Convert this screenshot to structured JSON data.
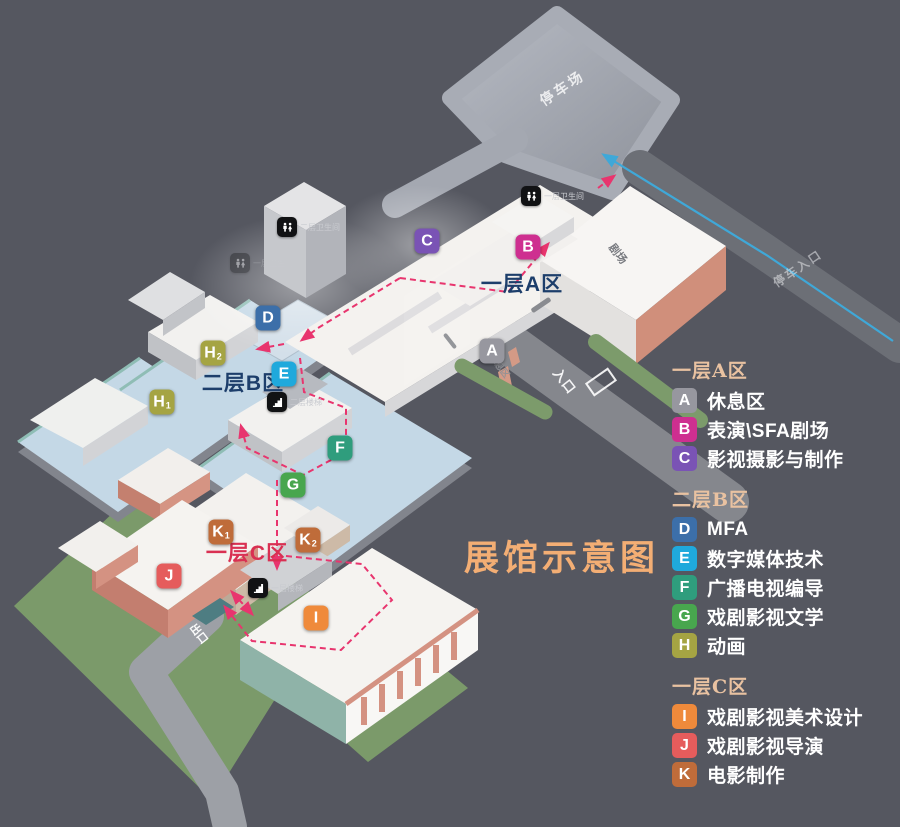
{
  "title": {
    "text": "展馆示意图"
  },
  "colors": {
    "background": "#555760",
    "title": "#f3ae74",
    "legend_header": "#e9c2a1",
    "route_pink": "#e8356e",
    "route_blue": "#3fa8d8",
    "grass": "#7b9a6a",
    "floor_blue": "#c4d8e6"
  },
  "map": {
    "zone_labels": [
      {
        "text": "一层A区",
        "x": 522,
        "y": 283,
        "color": "#1d3e6b"
      },
      {
        "text": "二层B区",
        "x": 243,
        "y": 382,
        "color": "#1d3e6b"
      },
      {
        "text": "一层C区",
        "x": 247,
        "y": 552,
        "color": "#d93052"
      }
    ],
    "markers": [
      {
        "letter": "A",
        "sub": "",
        "x": 492,
        "y": 351,
        "color": "#97979f"
      },
      {
        "letter": "B",
        "sub": "",
        "x": 528,
        "y": 247,
        "color": "#ce2f90"
      },
      {
        "letter": "C",
        "sub": "",
        "x": 427,
        "y": 241,
        "color": "#7a53b5"
      },
      {
        "letter": "D",
        "sub": "",
        "x": 268,
        "y": 318,
        "color": "#3c6fa9"
      },
      {
        "letter": "E",
        "sub": "",
        "x": 284,
        "y": 374,
        "color": "#1fa9dc"
      },
      {
        "letter": "F",
        "sub": "",
        "x": 340,
        "y": 448,
        "color": "#2f9d7d"
      },
      {
        "letter": "G",
        "sub": "",
        "x": 293,
        "y": 485,
        "color": "#48a64e"
      },
      {
        "letter": "H",
        "sub": "1",
        "x": 162,
        "y": 402,
        "color": "#a5a443"
      },
      {
        "letter": "H",
        "sub": "2",
        "x": 213,
        "y": 353,
        "color": "#a5a443"
      },
      {
        "letter": "I",
        "sub": "",
        "x": 316,
        "y": 618,
        "color": "#ef8a3b"
      },
      {
        "letter": "J",
        "sub": "",
        "x": 169,
        "y": 576,
        "color": "#e55c5c"
      },
      {
        "letter": "K",
        "sub": "1",
        "x": 221,
        "y": 532,
        "color": "#bf6c3a"
      },
      {
        "letter": "K",
        "sub": "2",
        "x": 308,
        "y": 540,
        "color": "#bf6c3a"
      }
    ],
    "facilities": [
      {
        "type": "restroom",
        "label": "一层卫生间",
        "x": 531,
        "y": 196,
        "faded": false
      },
      {
        "type": "restroom",
        "label": "二层卫生间",
        "x": 287,
        "y": 227,
        "faded": false
      },
      {
        "type": "restroom",
        "label": "一层卫生间",
        "x": 240,
        "y": 263,
        "faded": true
      },
      {
        "type": "stairs",
        "label": "二层楼梯",
        "x": 277,
        "y": 402,
        "faded": false
      },
      {
        "type": "stairs",
        "label": "一层楼梯",
        "x": 258,
        "y": 588,
        "faded": false
      }
    ],
    "road_labels": [
      {
        "text": "停车场",
        "x": 565,
        "y": 92,
        "rotate": -34,
        "size": 14,
        "color": "#ffffff",
        "opacity": 0.8,
        "spacing": 3
      },
      {
        "text": "停车入口",
        "x": 800,
        "y": 272,
        "rotate": -34,
        "size": 12,
        "color": "#e8e9ec",
        "opacity": 0.55,
        "spacing": 2
      },
      {
        "text": "入口",
        "x": 561,
        "y": 384,
        "rotate": 52,
        "size": 13,
        "color": "#ffffff",
        "opacity": 0.92,
        "spacing": 1
      },
      {
        "text": "出口",
        "x": 196,
        "y": 636,
        "rotate": 52,
        "size": 11,
        "color": "#ffffff",
        "opacity": 0.95,
        "spacing": 0
      },
      {
        "text": "剧场",
        "x": 615,
        "y": 256,
        "rotate": 52,
        "size": 11,
        "color": "#6b6d73",
        "opacity": 0.9,
        "spacing": 0
      },
      {
        "text": "休息区",
        "x": 497,
        "y": 368,
        "rotate": 52,
        "size": 9,
        "color": "#8f9196",
        "opacity": 0.9,
        "spacing": 0
      }
    ]
  },
  "legend": {
    "sections": [
      {
        "header": "一层A区",
        "items": [
          {
            "letter": "A",
            "color": "#97979f",
            "label": "休息区"
          },
          {
            "letter": "B",
            "color": "#ce2f90",
            "label": "表演\\SFA剧场"
          },
          {
            "letter": "C",
            "color": "#7a53b5",
            "label": "影视摄影与制作"
          }
        ]
      },
      {
        "header": "二层B区",
        "items": [
          {
            "letter": "D",
            "color": "#3c6fa9",
            "label": "MFA"
          },
          {
            "letter": "E",
            "color": "#1fa9dc",
            "label": "数字媒体技术"
          },
          {
            "letter": "F",
            "color": "#2f9d7d",
            "label": "广播电视编导"
          },
          {
            "letter": "G",
            "color": "#48a64e",
            "label": "戏剧影视文学"
          },
          {
            "letter": "H",
            "color": "#a5a443",
            "label": "动画"
          }
        ]
      },
      {
        "header": "一层C区",
        "items": [
          {
            "letter": "I",
            "color": "#ef8a3b",
            "label": "戏剧影视美术设计"
          },
          {
            "letter": "J",
            "color": "#e55c5c",
            "label": "戏剧影视导演"
          },
          {
            "letter": "K",
            "color": "#bf6c3a",
            "label": "电影制作"
          }
        ]
      }
    ]
  }
}
